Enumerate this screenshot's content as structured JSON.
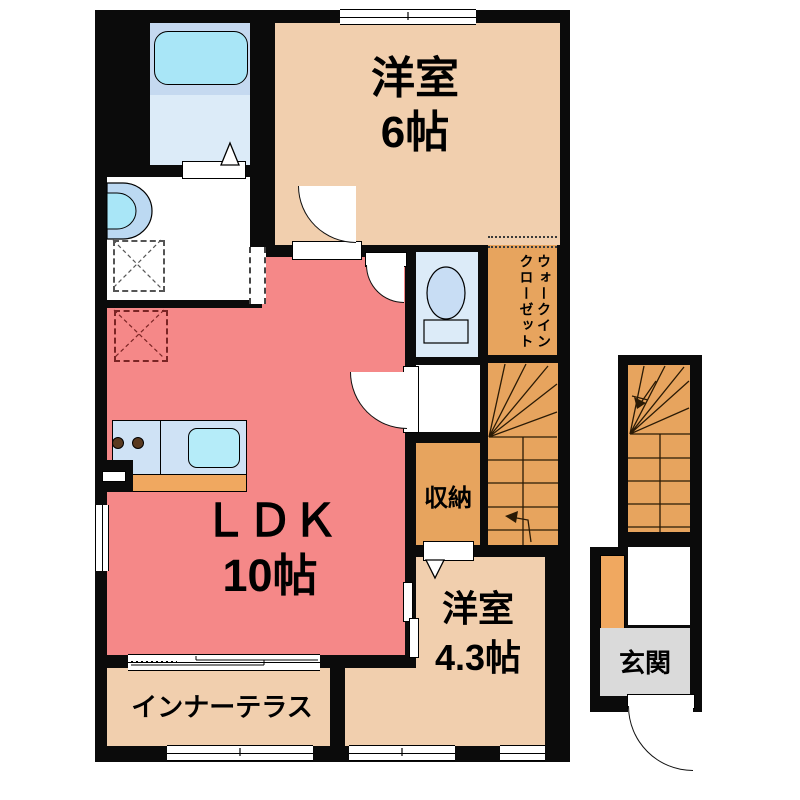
{
  "rooms": {
    "bedroom6": {
      "name": "洋室",
      "size": "6帖"
    },
    "ldk": {
      "name": "ＬＤＫ",
      "size": "10帖"
    },
    "bedroom43": {
      "name": "洋室",
      "size": "4.3帖"
    },
    "inner_terrace": {
      "name": "インナーテラス"
    },
    "storage": {
      "name": "収納"
    },
    "walk_in_closet": {
      "name_line1": "ウォークイン",
      "name_line2": "クローゼット"
    },
    "entrance": {
      "name": "玄関"
    }
  },
  "colors": {
    "wall": "#0b0b0b",
    "room_beige": "#f1cfae",
    "room_salmon": "#f58888",
    "room_orange": "#e7a45e",
    "accent_orange": "#f0a860",
    "bath_blue": "#dcebf8",
    "bath_band": "#c5d9f0",
    "tub_cyan": "#a9e6f7",
    "counter_blue": "#cfe2f5",
    "sink_cyan": "#b5ecf9",
    "toilet_fill": "#c8ddf4",
    "entrance_gray": "#dadada",
    "white": "#ffffff"
  }
}
